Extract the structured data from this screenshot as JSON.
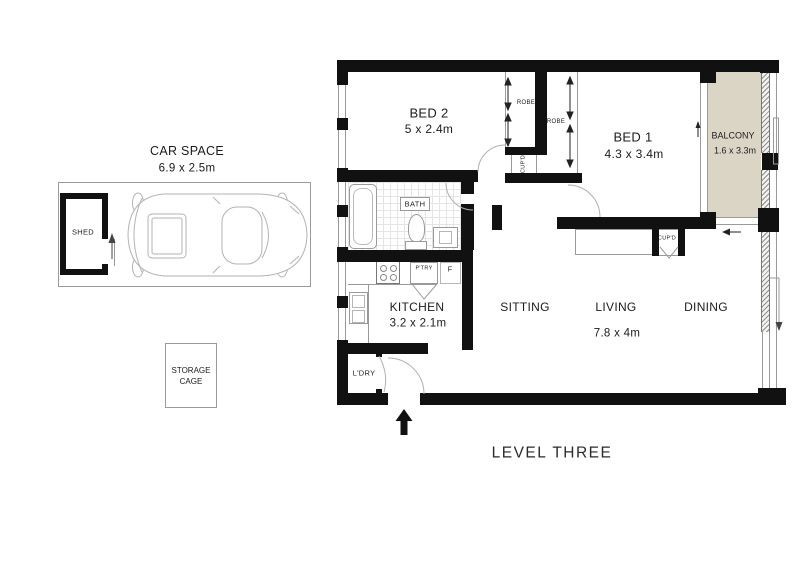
{
  "plan_title": "LEVEL THREE",
  "garage": {
    "car_space": {
      "label": "CAR SPACE",
      "dims": "6.9 x 2.5m"
    },
    "shed": {
      "label": "SHED"
    },
    "storage_cage": {
      "line1": "STORAGE",
      "line2": "CAGE"
    }
  },
  "apartment": {
    "bed2": {
      "label": "BED 2",
      "dims": "5 x 2.4m"
    },
    "bed1": {
      "label": "BED 1",
      "dims": "4.3 x 3.4m"
    },
    "balcony": {
      "label": "BALCONY",
      "dims": "1.6 x 3.3m"
    },
    "kitchen": {
      "label": "KITCHEN",
      "dims": "3.2 x 2.1m"
    },
    "sitting": {
      "label": "SITTING"
    },
    "living": {
      "label": "LIVING",
      "dims": "7.8 x 4m"
    },
    "dining": {
      "label": "DINING"
    },
    "bath": {
      "label": "BATH"
    },
    "laundry": {
      "label": "L'DRY"
    },
    "robe_bed2": {
      "label": "ROBE"
    },
    "robe_bed1": {
      "label": "ROBE"
    },
    "cupboard_hall": {
      "label": "CUP'D"
    },
    "cupboard_living": {
      "label": "CUP'D"
    },
    "pantry": {
      "label": "P'TRY"
    },
    "fridge": {
      "label": "F"
    }
  },
  "colors": {
    "wall": "#111111",
    "balcony_fill": "#dad5c4",
    "fine_line": "#9a9a9a"
  }
}
